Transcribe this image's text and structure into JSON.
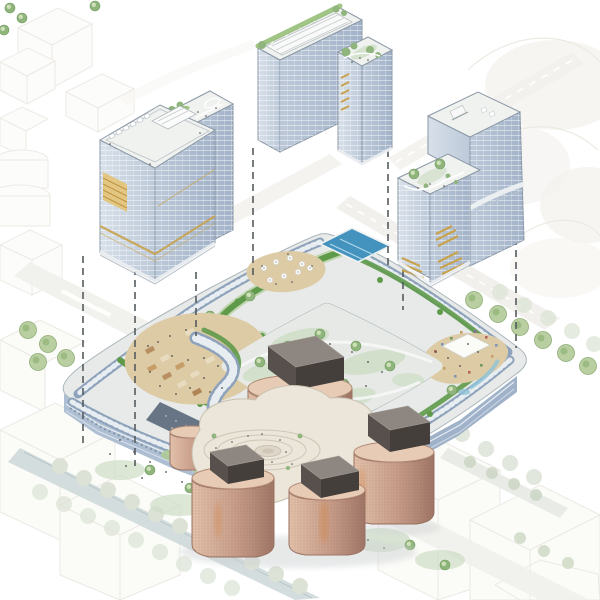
{
  "page": {
    "type": "architectural-exploded-axonometric-rendering",
    "description": "Masterplan rendering: three glass towers exploded above a retail podium ring with green roofs, a copper cylindrical pavilion cluster with circular plaza, dashed leader lines, canal and street trees, faint white context city blocks."
  },
  "palette": {
    "background": "#ffffff",
    "context_line": "#e4e1da",
    "street": "#f0efeb",
    "canal_water": "#cfd9da",
    "tree_faint": "#dce3d6",
    "tree_green": "#8fb57c",
    "tree_dark": "#6f9b5c",
    "glass_light": "#d8e0ea",
    "glass_mid": "#bcc9d9",
    "glass_dark": "#a2b2c8",
    "roof_white": "#f0f2f0",
    "roof_edge": "#8b98a6",
    "gold": "#c8a34e",
    "gold_light": "#e3c57c",
    "podium_band": "#8ea3bb",
    "podium_face": "#aebfd3",
    "podium_face_dark": "#9fb2c9",
    "ribbon_green": "#5f9a4a",
    "ribbon_green_light": "#9cc27e",
    "terrace_beige": "#ddcba6",
    "stall_brown": "#b98f62",
    "stall_light": "#e8dcc0",
    "pool_blue": "#4493bf",
    "canopy_white": "#fbfbf8",
    "plaza": "#e6e9e6",
    "sage": "#cdddc5",
    "copper_light": "#e2c0a9",
    "copper": "#c69c88",
    "copper_dark": "#9f7666",
    "copper_glow": "#d2813f",
    "cap_dark": "#57504c",
    "deck": "#ece6da",
    "deck_line": "#c9c0ae",
    "slate_roof": "#5d6a7c",
    "leader_line": "#555b5e",
    "shadow": "#cfd3d4"
  },
  "diagram": {
    "kind": "exploded-axonometric",
    "floating_towers": [
      "glass-tower-northwest",
      "glass-tower-north",
      "glass-tower-east"
    ],
    "ground_elements": [
      "retail-podium-ring",
      "central-courtyard",
      "rooftop-pool",
      "market-terraces",
      "event-canopy",
      "copper-pavilion-cluster",
      "circular-plaza",
      "canal",
      "street-trees",
      "context-blocks"
    ],
    "leader_lines_count": 7
  }
}
